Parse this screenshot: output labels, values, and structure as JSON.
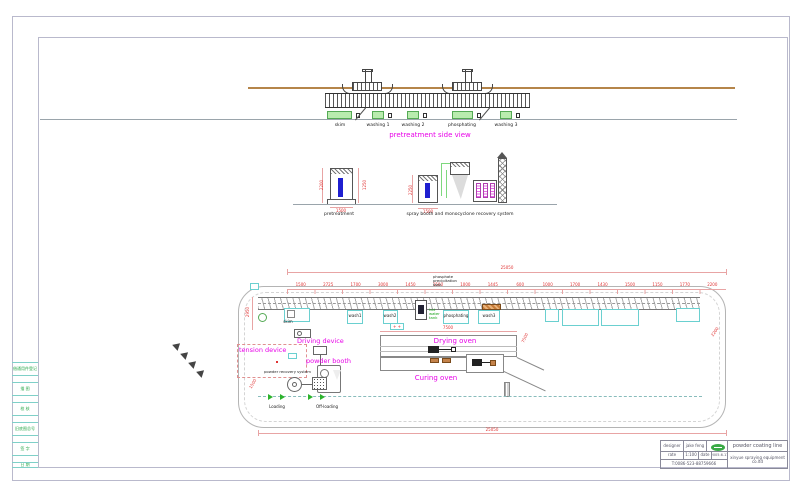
{
  "side_view": {
    "title": "pretreatment side view",
    "tank_labels": [
      "skim",
      "washing 1",
      "washing 2",
      "phosphating",
      "washing 3"
    ]
  },
  "elevation": {
    "pretreatment_label": "pretreatment",
    "booth_label": "spray booth and monocyclone recovery system"
  },
  "plan": {
    "phosphate_note": [
      "phosphate",
      "precipitation",
      "tank"
    ],
    "hot_water_note": [
      "hot",
      "water",
      "tank"
    ],
    "tension_device": "tension device",
    "driving_device": "Driving device",
    "powder_booth": "powder booth",
    "powder_recovery": "powder recovery system",
    "drying_oven": "Drying oven",
    "curing_oven": "Curing oven",
    "loading": "Loading",
    "offloading": "Off-loading",
    "tank_labels": [
      "skim",
      "wash1",
      "wash2",
      "phosphating",
      "wash3"
    ],
    "pump_marks": "+ +"
  },
  "dimensions": {
    "top_total": "25050",
    "bottom_total": "25050",
    "left_height": "2950",
    "oven_length": "7500",
    "diag_right": "7500",
    "loop_diag": "2200",
    "left_diag": "1500",
    "segments": [
      "1500",
      "2725",
      "1700",
      "3000",
      "1450",
      "1500",
      "1000",
      "1445",
      "600",
      "1000",
      "1700",
      "1430",
      "1500",
      "1150",
      "1770",
      "2200"
    ],
    "elev_dims": [
      "2200",
      "1250",
      "1500",
      "2250",
      "1500"
    ]
  },
  "title_block": {
    "designer_label": "designer",
    "designer_value": "jake feng",
    "scale_label": "rate",
    "scale_value": "1:100",
    "date_label": "date",
    "date_value": "2005.6.17",
    "phone": "T:0086-523-88759666",
    "product": "powder coating line",
    "company": "xinyue spraying equipment co.ltd"
  },
  "left_strip": {
    "items": [
      "借通用件登记",
      "描 图",
      "校 核",
      "旧底图总号",
      "签 字",
      "日 期"
    ]
  },
  "colors": {
    "annotation_magenta": "#e800e8",
    "dimension_red": "#e03333",
    "tank_green": "#b9ecae",
    "cad_cyan": "#6ad0d0",
    "liquid_blue": "#1f1fd0",
    "beam_brown": "#b5854a",
    "oven_orange": "#c4824a",
    "strip_text_green": "#2aa84a"
  }
}
